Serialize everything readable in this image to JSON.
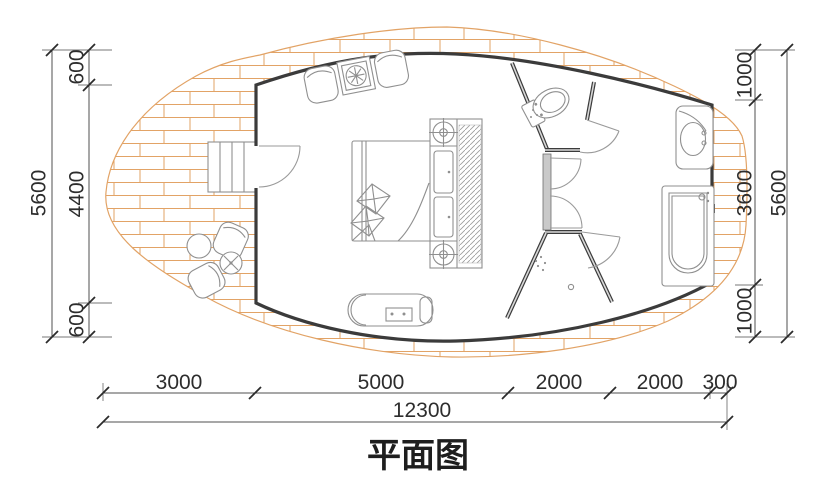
{
  "title": "平面图",
  "drawing_type": "architectural floor plan",
  "dims": {
    "left": {
      "segments": [
        "600",
        "4400",
        "600"
      ],
      "total": "5600"
    },
    "right": {
      "segments": [
        "1000",
        "3600",
        "1000"
      ],
      "total": "5600"
    },
    "bottom": {
      "segments": [
        "3000",
        "5000",
        "2000",
        "2000",
        "300"
      ],
      "total": "12300"
    }
  },
  "furniture_symbols": [
    "entry-stairs",
    "entry-door",
    "lounge-chairs",
    "fire-table",
    "double-bed",
    "pillows",
    "wardrobe-hatch",
    "bedside-light",
    "low-cabinet",
    "toilet",
    "washbasin",
    "bathtub",
    "shower",
    "outdoor-chair",
    "outdoor-table",
    "fire-pit"
  ],
  "colors": {
    "background": "#ffffff",
    "wall": "#3b3b3b",
    "deck_hatch": "#e2a366",
    "furniture_line": "#8f8f8f",
    "dimension_line": "#4f4f4f",
    "text": "#2d2d2d"
  }
}
